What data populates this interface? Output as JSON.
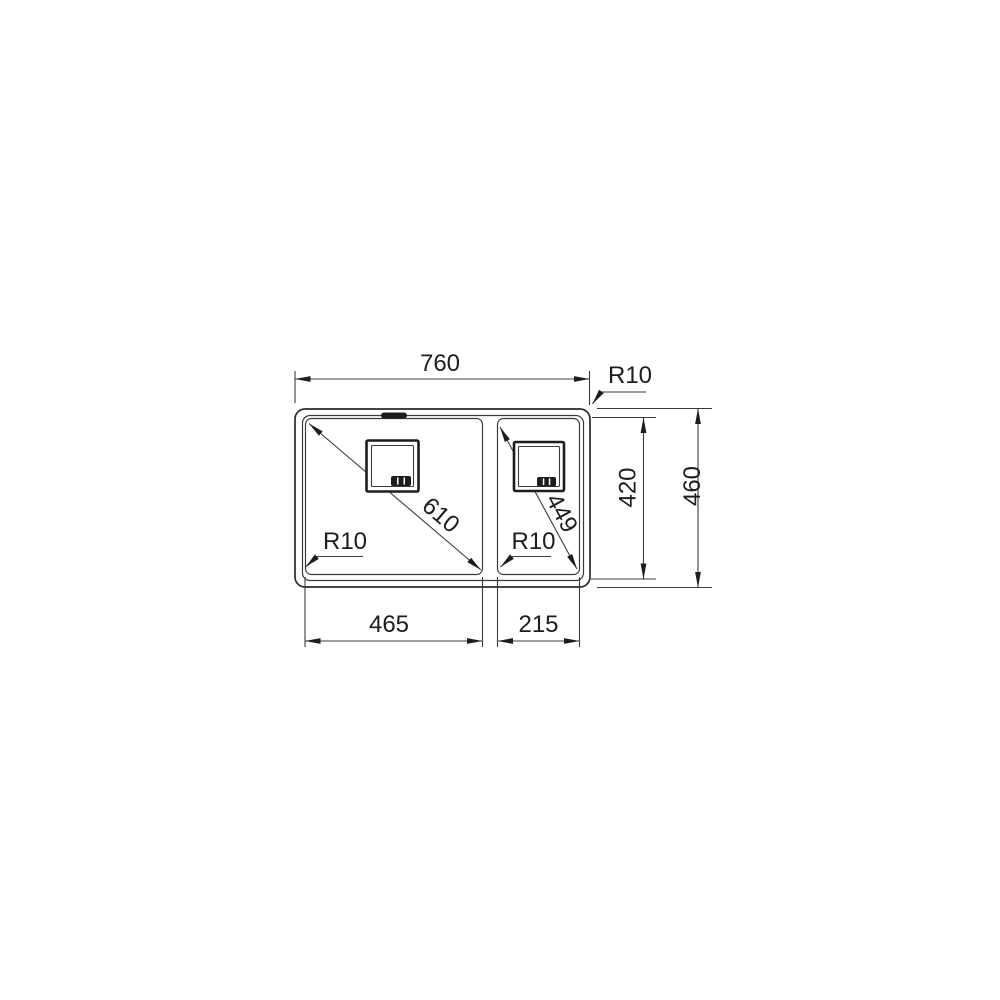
{
  "drawing": {
    "labels": {
      "overall_width": "760",
      "outer_corner_radius": "R10",
      "bowl_depth": "420",
      "overall_depth": "460",
      "left_bowl_width": "465",
      "right_bowl_width": "215",
      "left_bowl_diagonal": "610",
      "right_bowl_diagonal": "449",
      "left_bowl_corner_radius": "R10",
      "right_bowl_corner_radius": "R10"
    },
    "colors": {
      "line": "#3c3c3c",
      "dark": "#1d1d1d",
      "background": "#ffffff"
    }
  }
}
